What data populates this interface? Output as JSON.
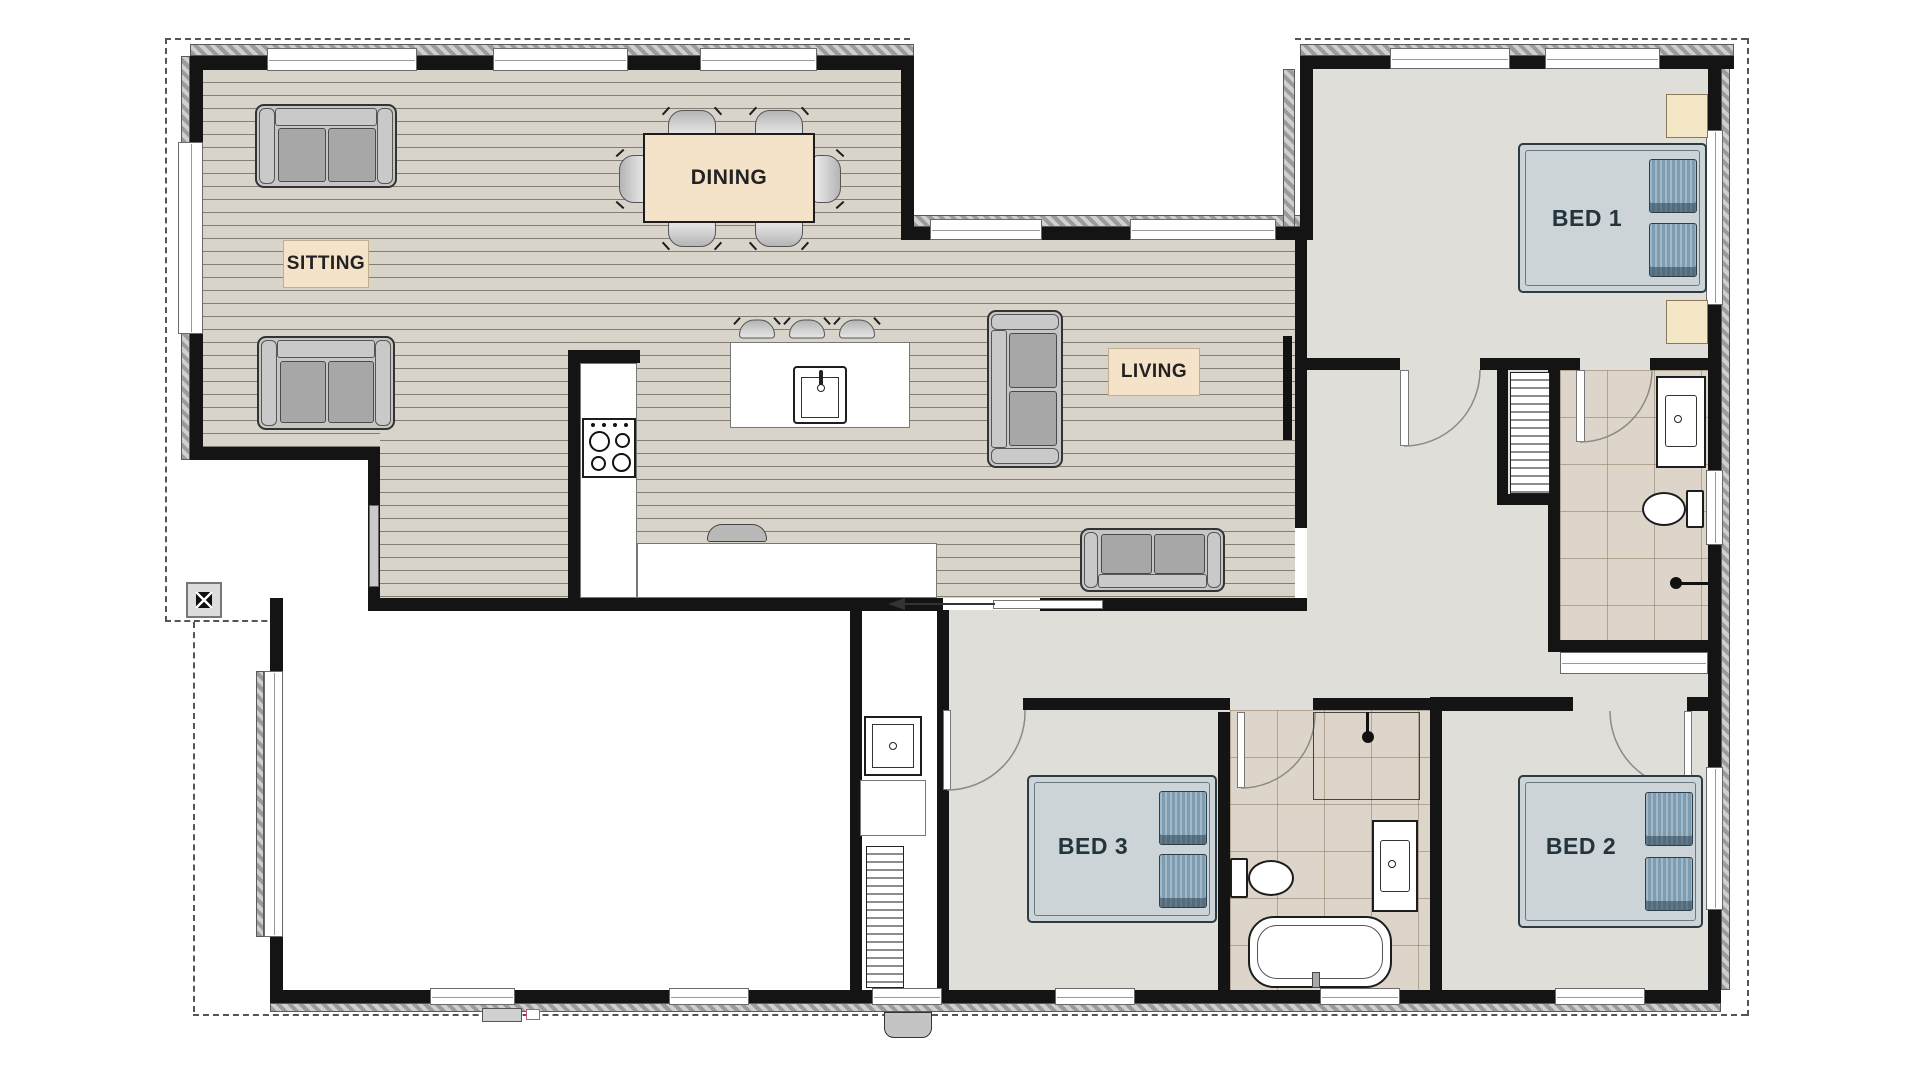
{
  "plan_title": "floor plan",
  "rooms": {
    "sitting": {
      "label": "SITTING"
    },
    "dining": {
      "label": "DINING"
    },
    "living": {
      "label": "LIVING"
    },
    "bed1": {
      "label": "BED 1"
    },
    "bed2": {
      "label": "BED 2"
    },
    "bed3": {
      "label": "BED 3"
    }
  },
  "palette": {
    "wall": "#141414",
    "wood_floor": "#d8d4c9",
    "carpet_floor": "#e0ded9",
    "tile_floor": "#ddd5c9",
    "label_background": "#f4e3c9",
    "bed_mattress": "#ccd4d7",
    "pillow": "#7e9db1",
    "nightstand": "#f4e7c6"
  }
}
